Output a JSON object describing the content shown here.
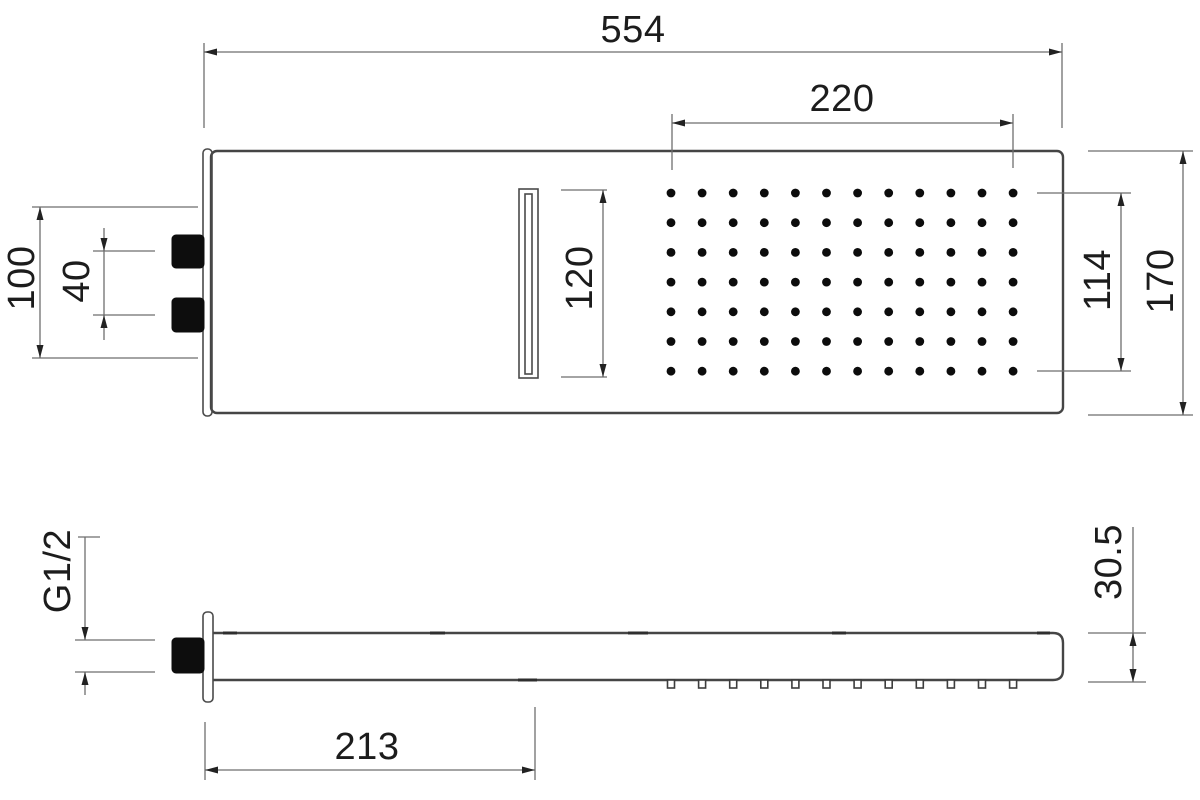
{
  "drawing": {
    "views": {
      "top": {
        "overall_width": "554",
        "spray_field_width": "220",
        "waterfall_slot_length": "120",
        "mount_span": "100",
        "inlet_spacing": "40",
        "spray_field_depth": "114",
        "overall_depth": "170"
      },
      "side": {
        "inlet_thread": "G1/2",
        "slot_offset_from_wall": "213",
        "body_thickness": "30.5"
      }
    },
    "spray_grid": {
      "columns": 12,
      "rows": 7
    },
    "colors": {
      "outline": "#454545",
      "dimension_line": "#6e6e6e",
      "ink": "#1c1c1c",
      "solid_black": "#0d0d0d",
      "background": "#ffffff"
    }
  }
}
